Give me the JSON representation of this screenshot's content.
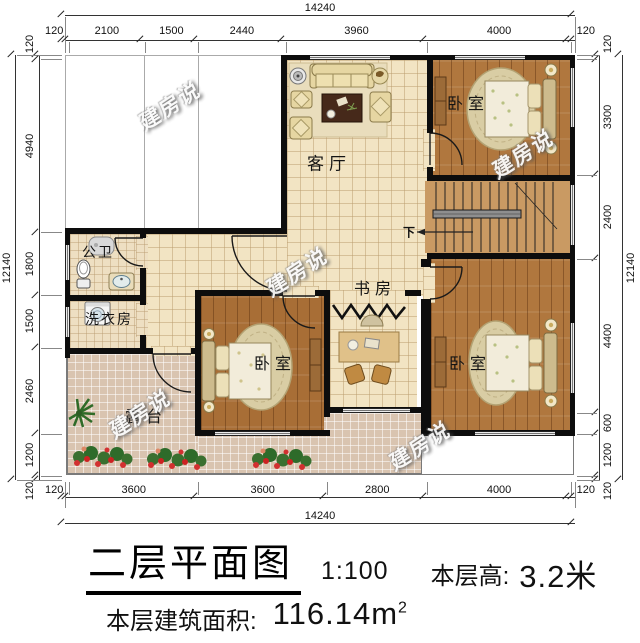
{
  "drawing": {
    "title": "二层平面图",
    "scale": "1:100",
    "floor_height_label": "本层高:",
    "floor_height_value": "3.2米",
    "floor_area_label": "本层建筑面积:",
    "floor_area_value": "116.14",
    "floor_area_unit": "m",
    "floor_area_exponent": "2"
  },
  "plan": {
    "watermark": "建房说",
    "stairs_down": "下"
  },
  "rooms": {
    "living_room": "客厅",
    "bedroom": "卧室",
    "study": "书房",
    "bathroom": "公卫",
    "laundry": "洗衣房",
    "terrace": "露台"
  },
  "dimensions": {
    "top": {
      "total": 14240,
      "segments": [
        120,
        2100,
        1500,
        2440,
        3960,
        4000,
        120
      ]
    },
    "bottom": {
      "total": 14240,
      "segments": [
        120,
        3600,
        3600,
        2800,
        4000,
        120
      ]
    },
    "left": {
      "total": 12140,
      "segments": [
        120,
        4940,
        1800,
        1500,
        2460,
        1200,
        120
      ]
    },
    "right": {
      "total": 12140,
      "segments": [
        120,
        3300,
        2400,
        4400,
        600,
        1200,
        120
      ]
    }
  },
  "colors": {
    "wall": "#0d0d0d",
    "tile_floor": "#f2e4c3",
    "wood_floor": "#b0773e",
    "terrace_floor": "#d9c4b0",
    "stairs_floor": "#c99a63"
  }
}
